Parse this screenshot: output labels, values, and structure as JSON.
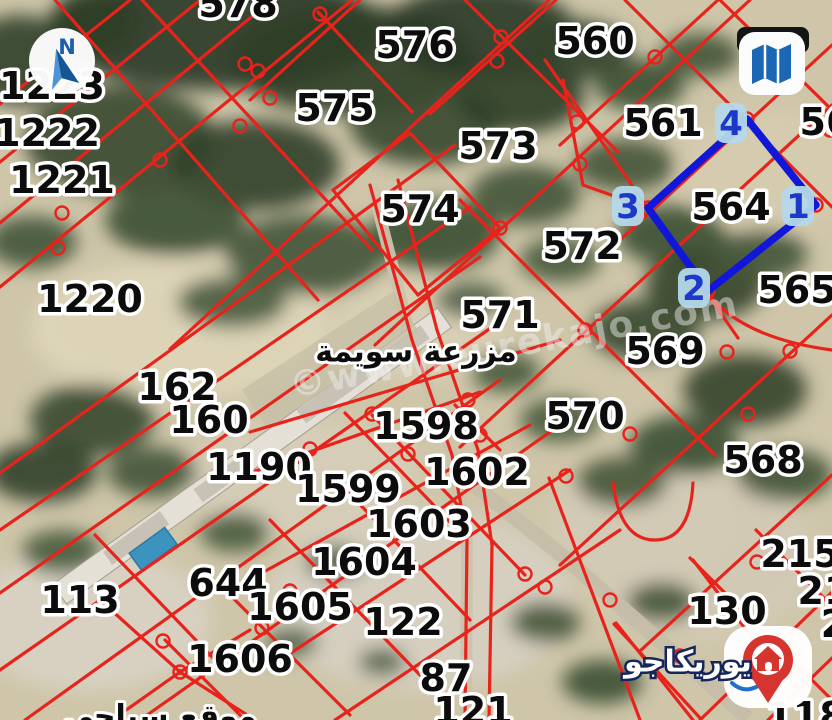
{
  "map": {
    "watermark": "©www.eurekajo.com",
    "farm_label": "مزرعة سويمة",
    "bottom_left_partial_label": "موقع سياحي",
    "logo": {
      "brand": "يوريكاجو"
    },
    "icons": {
      "compass_letter": "N"
    },
    "colors": {
      "parcel_line": "#e7231c",
      "selection_blue": "#1117d8",
      "badge_bg": "#b4d8ea",
      "badge_text": "#1d39c9",
      "label_text": "#0c0c0c",
      "label_outline": "#ffffff",
      "road": "#cbc3ad",
      "road_se": "#c6beaa",
      "pool_water": "#3c93bd",
      "logo_red": "#d6342f",
      "logo_navy": "#15265c",
      "compass_blue": "#1a5fae",
      "map_icon_blue": "#1b66b5",
      "watermark_color": "#efefef"
    },
    "parcel_labels": [
      {
        "t": "578",
        "x": 238,
        "y": 4
      },
      {
        "t": "576",
        "x": 415,
        "y": 45
      },
      {
        "t": "560",
        "x": 595,
        "y": 41
      },
      {
        "t": "575",
        "x": 335,
        "y": 108
      },
      {
        "t": "561",
        "x": 663,
        "y": 123
      },
      {
        "t": "56",
        "x": 826,
        "y": 122
      },
      {
        "t": "573",
        "x": 498,
        "y": 146
      },
      {
        "t": "574",
        "x": 420,
        "y": 209
      },
      {
        "t": "564",
        "x": 731,
        "y": 207
      },
      {
        "t": "572",
        "x": 582,
        "y": 246
      },
      {
        "t": "565",
        "x": 797,
        "y": 290
      },
      {
        "t": "1223",
        "x": 52,
        "y": 86
      },
      {
        "t": "1222",
        "x": 47,
        "y": 133
      },
      {
        "t": "1221",
        "x": 62,
        "y": 180
      },
      {
        "t": "1220",
        "x": 90,
        "y": 299
      },
      {
        "t": "571",
        "x": 500,
        "y": 315
      },
      {
        "t": "569",
        "x": 665,
        "y": 351
      },
      {
        "t": "162",
        "x": 177,
        "y": 387
      },
      {
        "t": "570",
        "x": 585,
        "y": 416
      },
      {
        "t": "160",
        "x": 209,
        "y": 420
      },
      {
        "t": "1598",
        "x": 426,
        "y": 426
      },
      {
        "t": "1190",
        "x": 259,
        "y": 467
      },
      {
        "t": "1602",
        "x": 477,
        "y": 472
      },
      {
        "t": "568",
        "x": 763,
        "y": 460
      },
      {
        "t": "1599",
        "x": 348,
        "y": 489
      },
      {
        "t": "1603",
        "x": 419,
        "y": 524
      },
      {
        "t": "215",
        "x": 800,
        "y": 554
      },
      {
        "t": "1604",
        "x": 364,
        "y": 562
      },
      {
        "t": "644",
        "x": 228,
        "y": 583
      },
      {
        "t": "21",
        "x": 824,
        "y": 591
      },
      {
        "t": "113",
        "x": 80,
        "y": 600
      },
      {
        "t": "1605",
        "x": 300,
        "y": 607
      },
      {
        "t": "130",
        "x": 727,
        "y": 611
      },
      {
        "t": "122",
        "x": 403,
        "y": 622
      },
      {
        "t": "2",
        "x": 834,
        "y": 624
      },
      {
        "t": "1606",
        "x": 240,
        "y": 659
      },
      {
        "t": "87",
        "x": 446,
        "y": 678
      },
      {
        "t": "121",
        "x": 473,
        "y": 711
      },
      {
        "t": "118",
        "x": 806,
        "y": 716
      }
    ],
    "selected_parcel": {
      "number": "564",
      "polygon": [
        [
          648,
          208
        ],
        [
          747,
          119
        ],
        [
          816,
          205
        ],
        [
          708,
          291
        ]
      ],
      "corners": [
        {
          "n": "1",
          "x": 798,
          "y": 206
        },
        {
          "n": "2",
          "x": 694,
          "y": 288
        },
        {
          "n": "3",
          "x": 628,
          "y": 206
        },
        {
          "n": "4",
          "x": 731,
          "y": 123
        }
      ]
    },
    "lines": [
      [
        0,
        104,
        130,
        0
      ],
      [
        0,
        162,
        200,
        0
      ],
      [
        0,
        223,
        272,
        0
      ],
      [
        0,
        287,
        352,
        0
      ],
      [
        55,
        0,
        318,
        300
      ],
      [
        0,
        473,
        455,
        145
      ],
      [
        0,
        530,
        470,
        207
      ],
      [
        0,
        593,
        480,
        257
      ],
      [
        0,
        670,
        495,
        325
      ],
      [
        25,
        720,
        500,
        380
      ],
      [
        140,
        720,
        560,
        425
      ],
      [
        95,
        535,
        215,
        660
      ],
      [
        180,
        672,
        100,
        600
      ],
      [
        180,
        672,
        250,
        630
      ],
      [
        180,
        672,
        255,
        720
      ],
      [
        180,
        672,
        112,
        720
      ],
      [
        142,
        0,
        372,
        250
      ],
      [
        318,
        12,
        412,
        112
      ],
      [
        333,
        190,
        410,
        133
      ],
      [
        333,
        190,
        418,
        295
      ],
      [
        410,
        133,
        500,
        228
      ],
      [
        418,
        295,
        500,
        228
      ],
      [
        460,
        200,
        715,
        455
      ],
      [
        545,
        60,
        738,
        338
      ],
      [
        465,
        0,
        618,
        152
      ],
      [
        625,
        0,
        832,
        207
      ],
      [
        720,
        0,
        832,
        110
      ],
      [
        250,
        100,
        360,
        0
      ],
      [
        430,
        114,
        556,
        0
      ],
      [
        560,
        145,
        718,
        0
      ],
      [
        620,
        240,
        832,
        45
      ],
      [
        170,
        349,
        549,
        0
      ],
      [
        375,
        345,
        750,
        0
      ],
      [
        460,
        447,
        832,
        105
      ],
      [
        560,
        565,
        832,
        315
      ],
      [
        640,
        651,
        832,
        475
      ],
      [
        563,
        80,
        583,
        185
      ],
      [
        583,
        185,
        648,
        208
      ],
      [
        230,
        480,
        480,
        392
      ],
      [
        240,
        585,
        530,
        425
      ],
      [
        280,
        660,
        570,
        470
      ],
      [
        335,
        720,
        620,
        530
      ],
      [
        372,
        415,
        525,
        575
      ],
      [
        345,
        413,
        450,
        522
      ],
      [
        330,
        473,
        470,
        620
      ],
      [
        270,
        520,
        420,
        675
      ],
      [
        230,
        595,
        350,
        715
      ],
      [
        165,
        640,
        245,
        720
      ],
      [
        455,
        405,
        500,
        450
      ],
      [
        250,
        432,
        560,
        340
      ],
      [
        549,
        478,
        640,
        720
      ],
      [
        616,
        623,
        693,
        720
      ],
      [
        693,
        560,
        779,
        673
      ],
      [
        690,
        558,
        832,
        700
      ],
      [
        756,
        530,
        832,
        606
      ],
      [
        700,
        720,
        832,
        592
      ],
      [
        768,
        720,
        832,
        658
      ],
      [
        614,
        624,
        700,
        718
      ],
      [
        370,
        185,
        412,
        340
      ],
      [
        412,
        340,
        452,
        455
      ],
      [
        452,
        455,
        467,
        540
      ],
      [
        467,
        540,
        465,
        720
      ],
      [
        398,
        180,
        437,
        330
      ],
      [
        437,
        330,
        478,
        450
      ],
      [
        478,
        450,
        492,
        545
      ],
      [
        492,
        545,
        489,
        720
      ]
    ],
    "curves": [
      "M705,290 Q740,338 832,350",
      "M613,483 Q620,540 655,540 Q690,540 693,483"
    ],
    "circles": [
      [
        245,
        64
      ],
      [
        258,
        71
      ],
      [
        270,
        98
      ],
      [
        240,
        126
      ],
      [
        320,
        14
      ],
      [
        501,
        37
      ],
      [
        497,
        61
      ],
      [
        577,
        122
      ],
      [
        580,
        164
      ],
      [
        655,
        57
      ],
      [
        648,
        208
      ],
      [
        747,
        119
      ],
      [
        816,
        205
      ],
      [
        708,
        291
      ],
      [
        727,
        352
      ],
      [
        790,
        351
      ],
      [
        748,
        414
      ],
      [
        160,
        160
      ],
      [
        62,
        213
      ],
      [
        310,
        449
      ],
      [
        408,
        454
      ],
      [
        372,
        414
      ],
      [
        468,
        400
      ],
      [
        480,
        435
      ],
      [
        415,
        526
      ],
      [
        545,
        587
      ],
      [
        610,
        600
      ],
      [
        680,
        656
      ],
      [
        757,
        562
      ],
      [
        797,
        680
      ],
      [
        290,
        591
      ],
      [
        262,
        628
      ],
      [
        180,
        672
      ],
      [
        163,
        641
      ],
      [
        58,
        248
      ],
      [
        525,
        574
      ],
      [
        566,
        476
      ],
      [
        630,
        434
      ],
      [
        830,
        130
      ],
      [
        500,
        228
      ],
      [
        585,
        330
      ]
    ],
    "roads": [
      {
        "d": "M372,185 L410,335 L450,450 L467,535 L466,720",
        "w": 12
      },
      {
        "d": "M458,472 L565,558 L748,718",
        "w": 15
      }
    ]
  }
}
